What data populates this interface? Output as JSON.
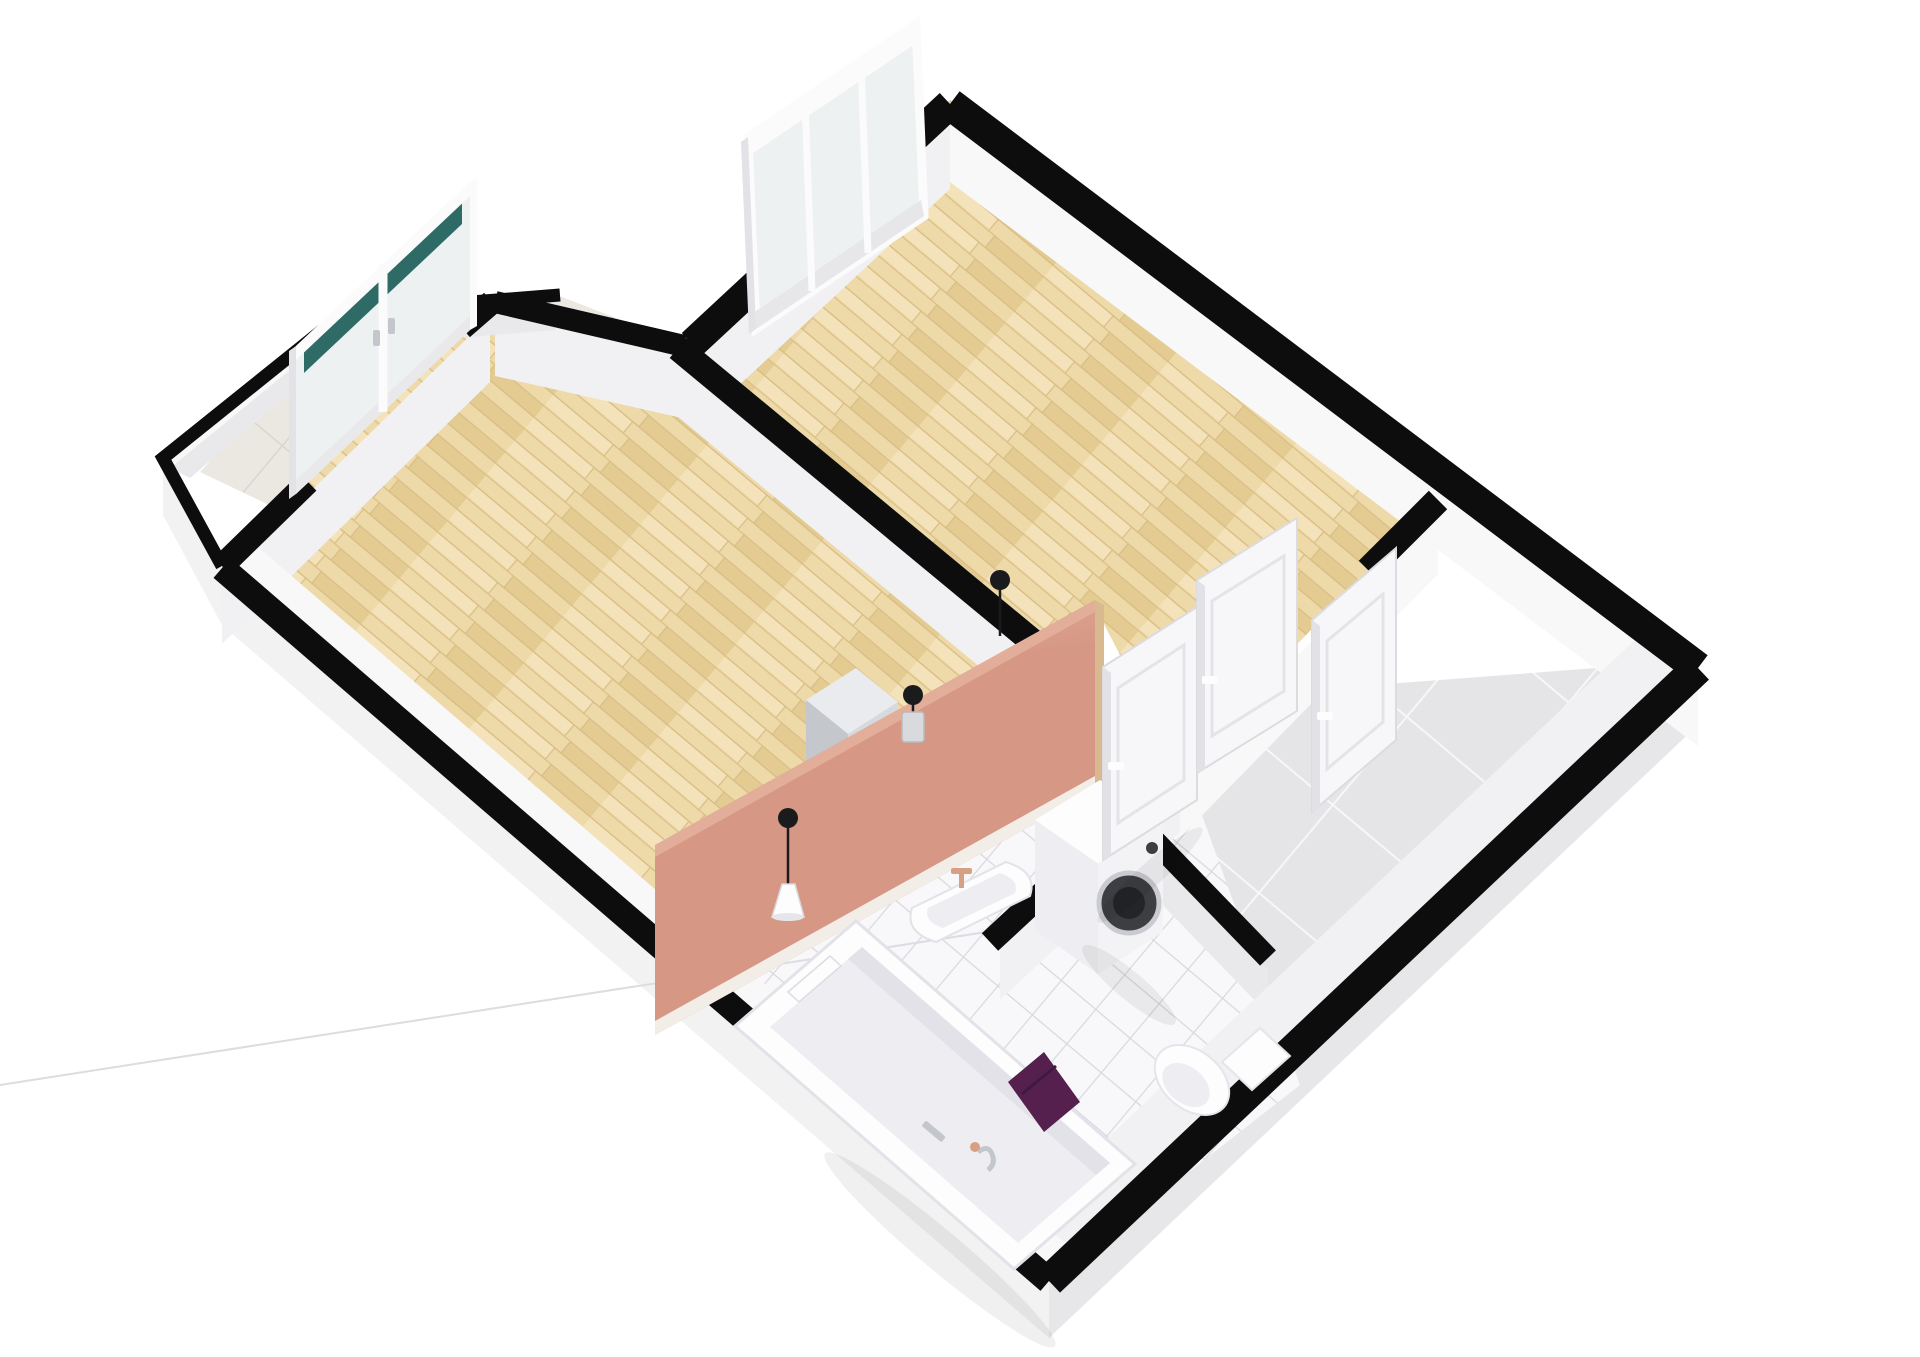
{
  "scene": {
    "kind": "3d-floorplan-render",
    "view": "isometric-birdseye",
    "rooms": [
      {
        "id": "bedroom",
        "floor": "light-wood"
      },
      {
        "id": "living-room",
        "floor": "light-wood"
      },
      {
        "id": "bathroom",
        "floor": "white-tile"
      },
      {
        "id": "hallway",
        "floor": "gray-tile"
      },
      {
        "id": "balcony",
        "floor": "stone-tile"
      }
    ],
    "features": {
      "accent_wall": "salmon-partition",
      "window": "triple-pane-window",
      "balcony_doors": "double-french-doors",
      "bedroom_doors": 2,
      "entry_door": 1
    },
    "fixtures": [
      "bathtub",
      "towel",
      "bath-rail",
      "wall-sink",
      "washing-machine",
      "toilet",
      "cabinet",
      "pendant-lamp",
      "pendant-lamp",
      "pendant-lamp"
    ]
  },
  "colors": {
    "background": "#ffffff",
    "wall_top": "#0d0d0d",
    "wall_face": "#f1f1f3",
    "wall_face_bright": "#f8f8f9",
    "wall_face_dim": "#e9e9ec",
    "plinth": "#f2f2f3",
    "plinth_dim": "#e7e7ea",
    "wood_base": "#eed9a8",
    "wood_dark": "#e3cb92",
    "wood_light": "#f4e3ba",
    "wood_line": "#d8bd85",
    "hall_tile": "#e5e5e8",
    "hall_grout": "#f7f7f9",
    "bath_tile": "#f8f8fa",
    "bath_grout": "#d8d8dd",
    "balcony_tile": "#eae8e1",
    "balcony_grout": "#d9d6cf",
    "salmon": "#d69884",
    "salmon_light": "#e2ad99",
    "salmon_cap": "#d9ba90",
    "skirting": "#f3ede8",
    "fixture": "#fdfdfe",
    "fixture_mid": "#eeeef2",
    "fixture_shadow": "#dcdce2",
    "towel": "#55204e",
    "teal_glass": "#2e6b67",
    "glass": "#eef1f1",
    "door_white": "#f7f7f9",
    "door_edge": "#d9d9dd",
    "washer_door": "#3c3e42",
    "washer_ring": "#c9cbd0",
    "washer_glass": "#232528",
    "metal": "#c3c6cb",
    "lamp_black": "#1b1b1d",
    "cabinet_top": "#e9ebee",
    "cabinet_side": "#c4c8cd",
    "cabinet_front": "#d6d9dd",
    "faucet_tan": "#d7a083",
    "shadow": "#000000"
  }
}
